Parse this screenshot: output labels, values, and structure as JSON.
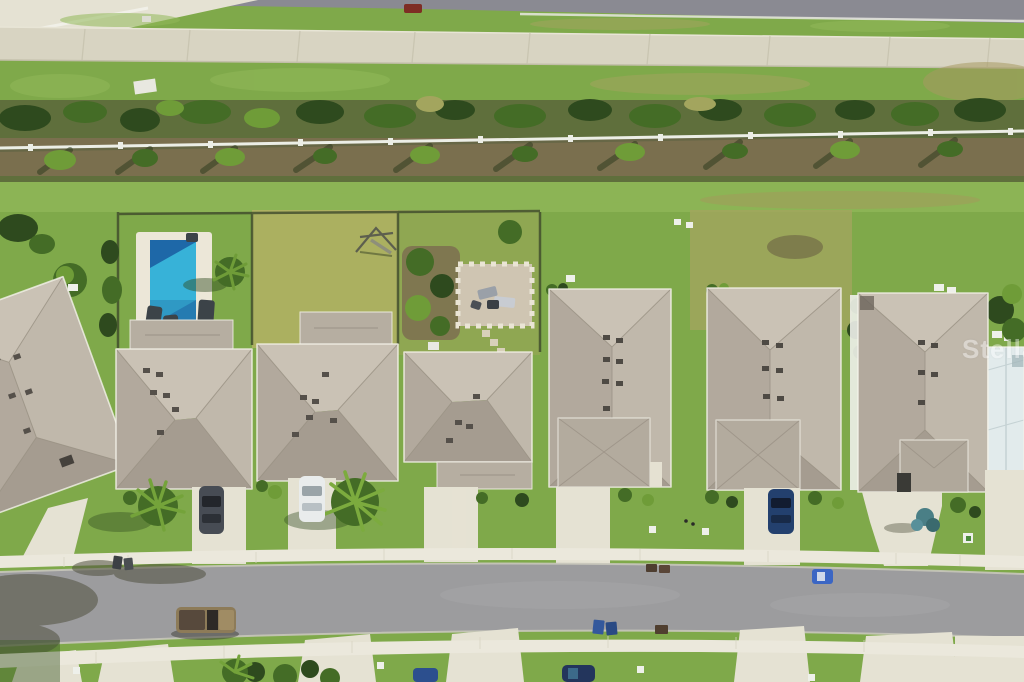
{
  "meta": {
    "type": "aerial-drone-photograph",
    "subject": "overhead view of a row of single-family homes with gray shingle hip roofs along a curved residential street, backyards facing a landscaped buffer, walking trail and main road at top",
    "width": 1024,
    "height": 682
  },
  "watermark": {
    "text": "Stellar MLS",
    "color": "#ffffff",
    "opacity": 0.42
  },
  "colors": {
    "grassBase": "#7fa94a",
    "grassLight": "#92b95a",
    "grassYellow": "#b3b164",
    "grassDry": "#a3a55e",
    "asphaltTop": "#8a8a92",
    "street": "#9c9c9e",
    "concrete": "#e5e2d3",
    "sidewalk": "#ebe8dc",
    "trail": "#d8d4c2",
    "mulch": "#7d6f50",
    "bufferBase": "#5f6f3c",
    "bushDark": "#2e4a1e",
    "bushMid": "#446c26",
    "bushLight": "#6f9c38",
    "roofTop": "#cac2b5",
    "roofRight": "#c0b8ab",
    "roofBottom": "#a59c90",
    "roofLeft": "#b2a99d",
    "roofGarage": "#b6aea1",
    "hipLine": "#9b9286",
    "eaveWhite": "#f4f2ea",
    "poolDeck": "#ece7d8",
    "poolDeep": "#1e68a8",
    "poolCyan": "#3cc0e0",
    "fenceWhite": "#eceee6",
    "screenRoof": "#e2ebec",
    "wmColor": "#ffffff",
    "wmOpacity": "0.42"
  },
  "scene": {
    "bands_top_to_bottom": [
      "main road (asphalt, top edge)",
      "grass verge",
      "concrete walking trail",
      "grass",
      "landscape buffer: hedge row, white rail fence, palms and mulch",
      "common grass strip behind lots",
      "backyards (pool, swing set, paver patio)",
      "row of 7 gray hip-roof homes plus white screened enclosure at right edge",
      "front lawns with driveways and sidewalk",
      "residential street",
      "lower sidewalk and front lawns of opposite lots"
    ],
    "amenities": [
      {
        "name": "swimming-pool",
        "lot": 2
      },
      {
        "name": "swing-set",
        "lot": 3
      },
      {
        "name": "paver-patio-with-loungers",
        "lot": 4
      }
    ],
    "vehicles": [
      {
        "name": "car-on-main-road",
        "color": "#7e2d24"
      },
      {
        "name": "dark-gray-car-driveway-2",
        "color": "#474c54"
      },
      {
        "name": "white-car-driveway-3",
        "color": "#e9ecec"
      },
      {
        "name": "navy-car-driveway-6",
        "color": "#23406e"
      },
      {
        "name": "tan-pickup-truck-on-street",
        "color": "#8d7b58"
      },
      {
        "name": "blue-car-driving-on-street",
        "color": "#3b66c4"
      },
      {
        "name": "blue-car-bottom-lot",
        "color": "#2c4f8e"
      },
      {
        "name": "dark-blue-car-bottom-lot",
        "color": "#23355c"
      }
    ],
    "house_count": 7
  }
}
